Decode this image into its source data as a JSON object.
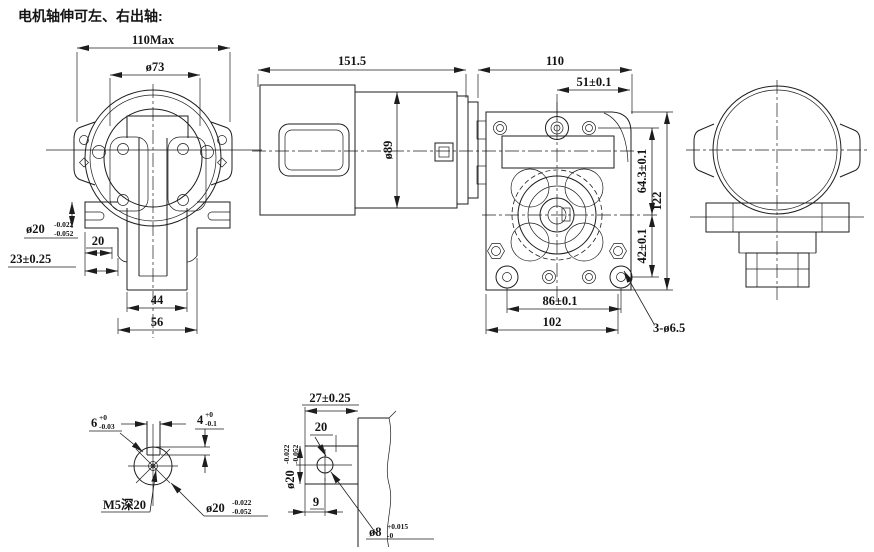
{
  "title": "电机轴伸可左、右出轴:",
  "front_view": {
    "dim_width_max": "110Max",
    "dim_flange_dia": "ø73",
    "shaft_dia": {
      "base": "ø20",
      "upper": "-0.022",
      "lower": "-0.052"
    },
    "dim_shaft_len": "20",
    "dim_shaft_ext": "23±0.25",
    "dim_hub_inner": "44",
    "dim_hub_outer": "56"
  },
  "side_view": {
    "dim_total_len": "151.5",
    "dim_gearbox_width": "110",
    "dim_hole_offset": "51±0.1",
    "dim_motor_dia": "ø89"
  },
  "face_view": {
    "dim_upper": "64.3±0.1",
    "dim_lower": "42±0.1",
    "dim_height": "122",
    "dim_hole_span": "86±0.1",
    "dim_width": "102",
    "dim_mount_holes": "3-ø6.5"
  },
  "shaft_end_detail": {
    "key_width": {
      "base": "6",
      "upper": "+0",
      "lower": "-0.03"
    },
    "key_depth": {
      "base": "4",
      "upper": "+0",
      "lower": "-0.1"
    },
    "tap": "M5深20",
    "shaft_dia": {
      "base": "ø20",
      "upper": "-0.022",
      "lower": "-0.052"
    }
  },
  "shaft_side_detail": {
    "dim_length": "27±0.25",
    "dim_key_len": "20",
    "shaft_dia": {
      "base": "ø20",
      "upper": "-0.022",
      "lower": "-0.052"
    },
    "dim_hole_pos": "9",
    "hole_dia": {
      "base": "ø8",
      "upper": "+0.015",
      "lower": "-0"
    }
  }
}
